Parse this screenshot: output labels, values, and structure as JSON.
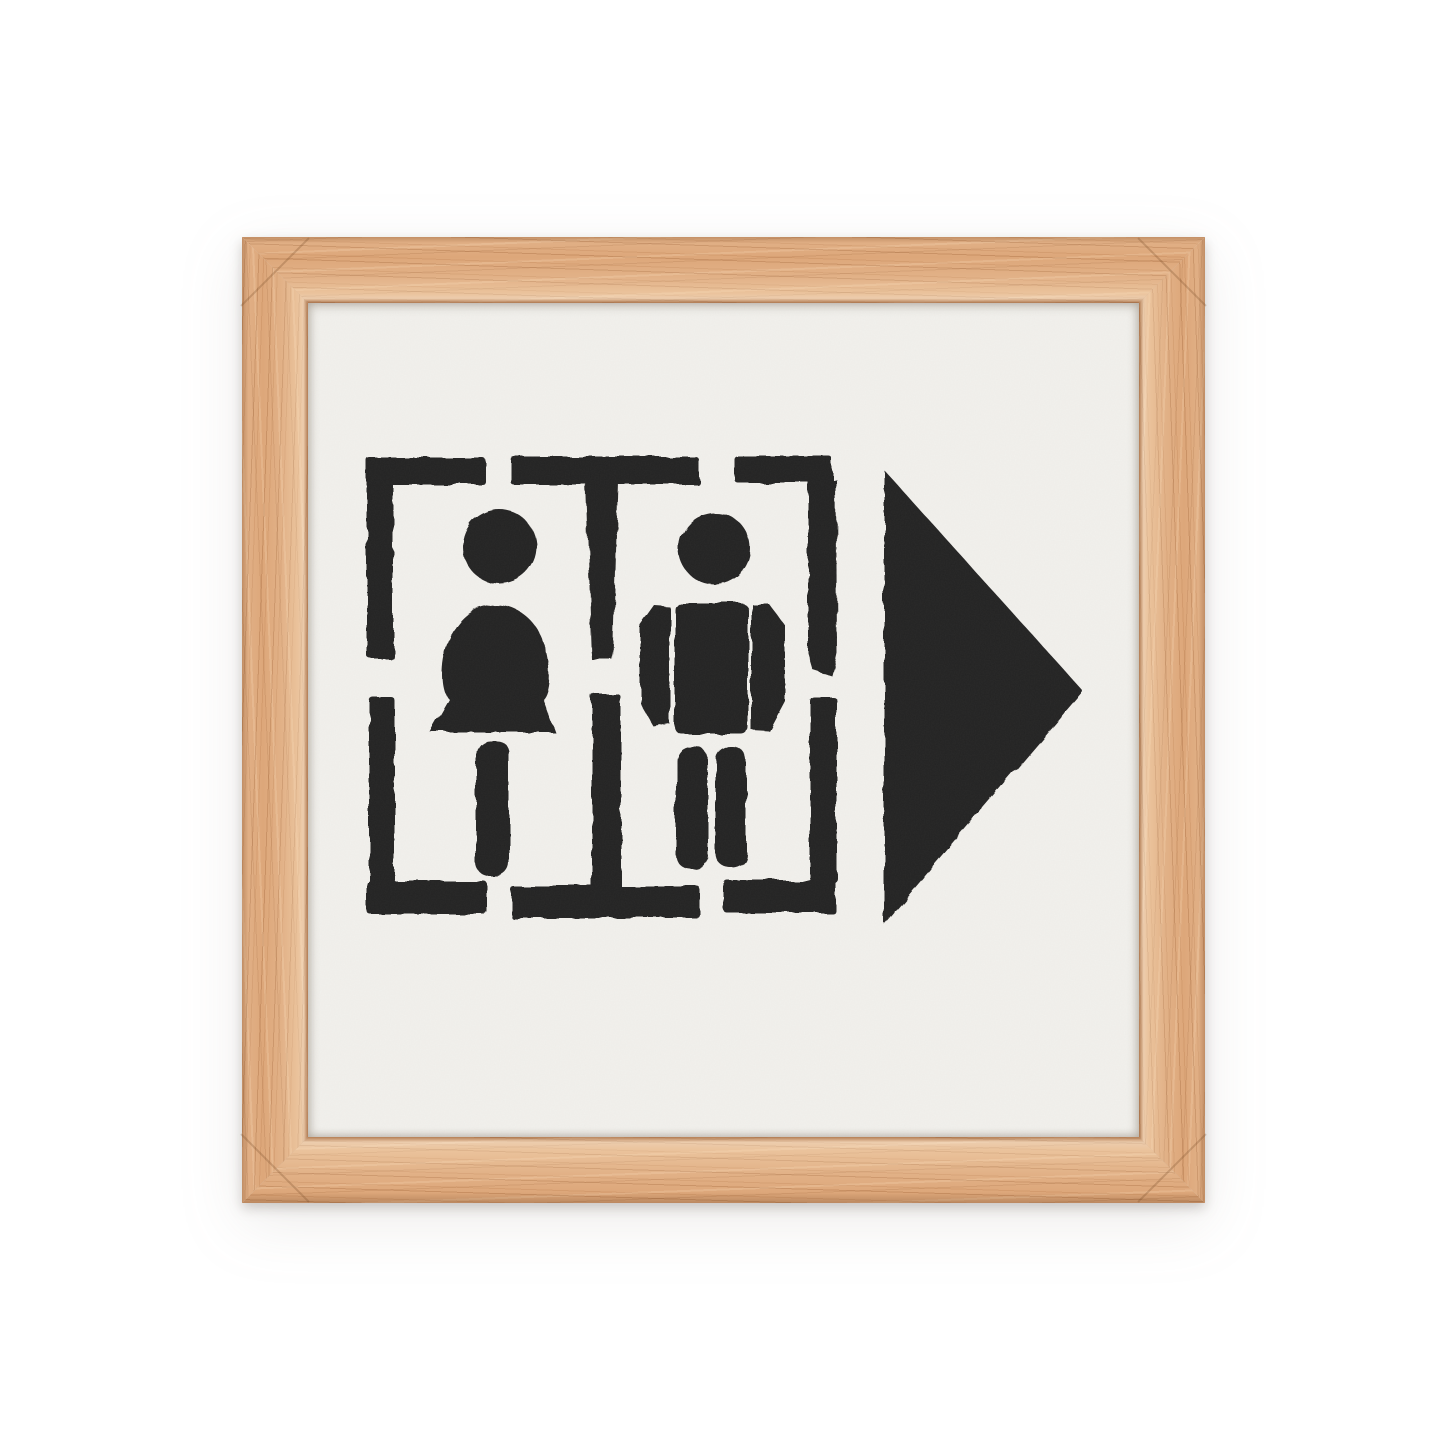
{
  "scene": {
    "background_color": "#ffffff",
    "product": {
      "kind": "framed stencil print",
      "frame": {
        "wood_tone": "oak",
        "base_color": "#dda77a",
        "grain_color": "#96582c",
        "highlight_color": "#f3d9b4",
        "thickness_px": 66
      },
      "print": {
        "paper_color": "#f2f1ed",
        "ink_color": "#232020",
        "subject": "Stencil restroom sign: woman and man pictograms inside dashed stencil boxes with a large solid arrow pointing right",
        "icons": [
          {
            "name": "woman-icon",
            "label": "woman pictogram"
          },
          {
            "name": "man-icon",
            "label": "man pictogram"
          },
          {
            "name": "arrow-right-icon",
            "label": "arrow pointing right"
          }
        ]
      }
    }
  }
}
